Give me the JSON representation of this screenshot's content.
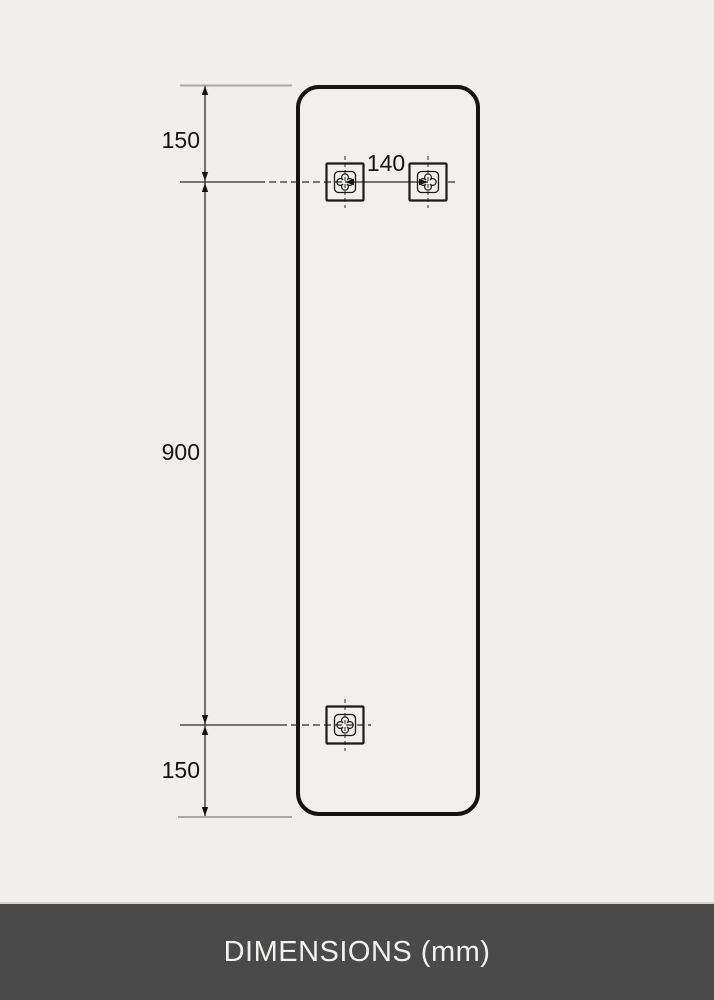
{
  "footer": {
    "title": "DIMENSIONS (mm)"
  },
  "diagram": {
    "unit": "mm",
    "labels": {
      "top_offset": "150",
      "panel_span": "900",
      "bottom_offset": "150",
      "mount_spacing": "140"
    },
    "measurements": {
      "top_mount_offset_mm": 150,
      "between_mounts_mm": 900,
      "bottom_mount_offset_mm": 150,
      "mount_horizontal_spacing_mm": 140
    },
    "colors": {
      "background": "#f0efed",
      "outline": "#141414",
      "dimension_line": "#2b2b2b",
      "extension_line": "#a8a8a6",
      "footer_background": "#4a4a4a",
      "footer_text": "#f1f1ef"
    }
  }
}
